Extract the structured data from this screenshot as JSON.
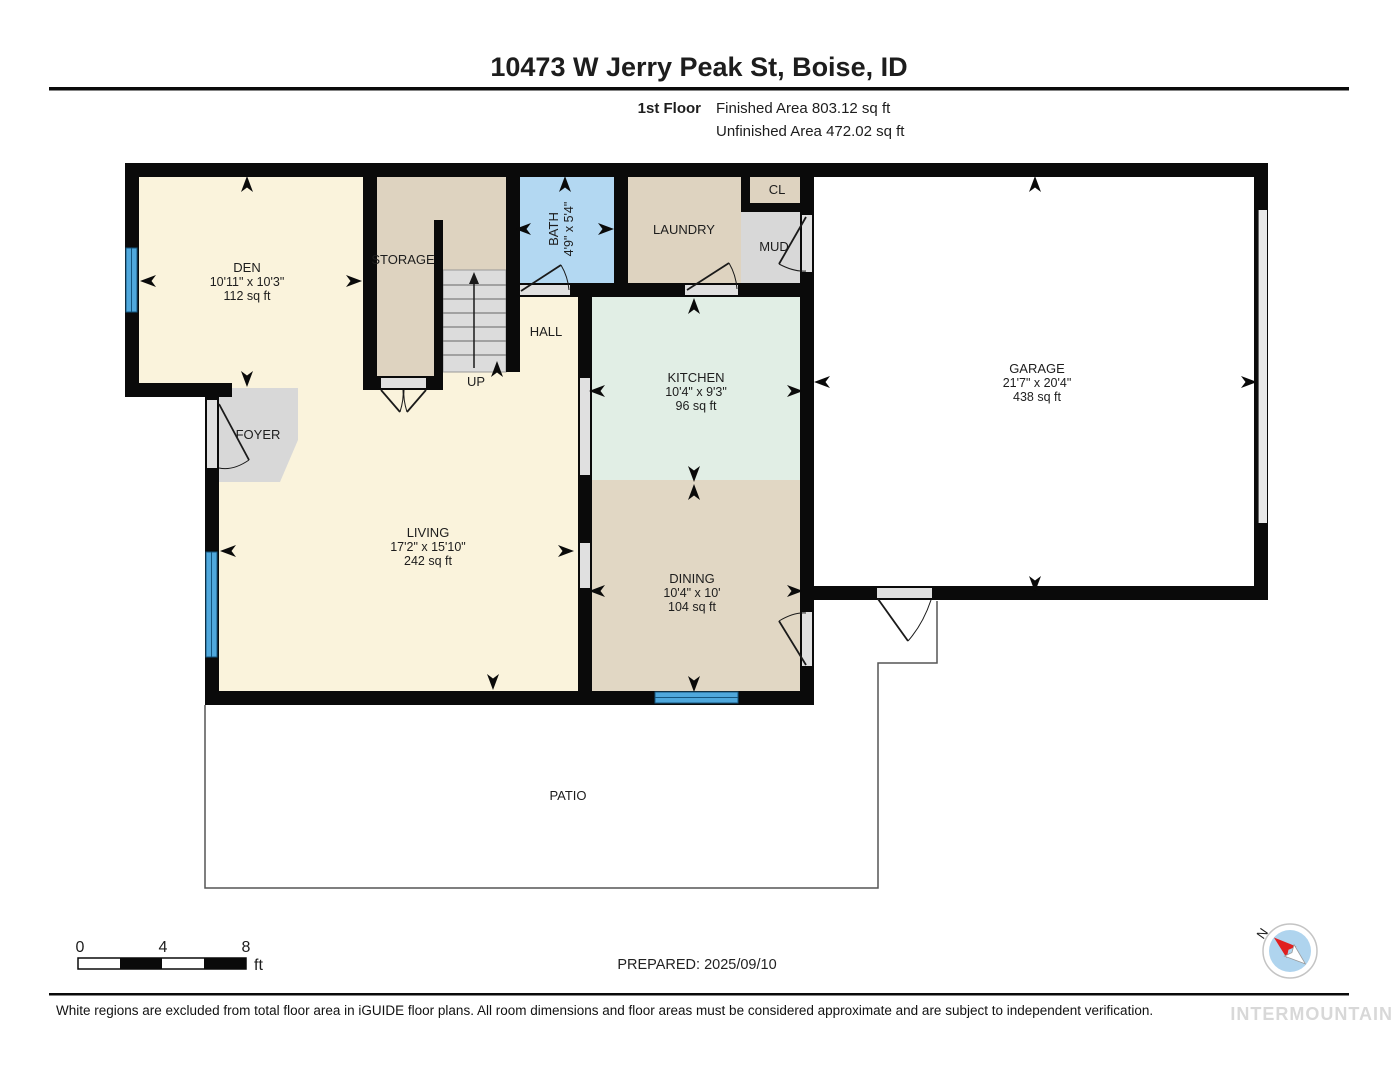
{
  "header": {
    "title": "10473 W Jerry Peak St, Boise, ID",
    "floor_label": "1st Floor",
    "finished": "Finished Area 803.12 sq ft",
    "unfinished": "Unfinished Area 472.02 sq ft"
  },
  "rooms": {
    "den": {
      "name": "DEN",
      "dims": "10'11\" x 10'3\"",
      "area": "112 sq ft"
    },
    "storage": {
      "name": "STORAGE"
    },
    "bath": {
      "name": "BATH",
      "dims": "4'9\" x 5'4\""
    },
    "laundry": {
      "name": "LAUNDRY"
    },
    "closet": {
      "name": "CL"
    },
    "mud": {
      "name": "MUD"
    },
    "hall": {
      "name": "HALL"
    },
    "up": {
      "name": "UP"
    },
    "foyer": {
      "name": "FOYER"
    },
    "kitchen": {
      "name": "KITCHEN",
      "dims": "10'4\" x 9'3\"",
      "area": "96 sq ft"
    },
    "garage": {
      "name": "GARAGE",
      "dims": "21'7\" x 20'4\"",
      "area": "438 sq ft"
    },
    "living": {
      "name": "LIVING",
      "dims": "17'2\" x 15'10\"",
      "area": "242 sq ft"
    },
    "dining": {
      "name": "DINING",
      "dims": "10'4\" x 10'",
      "area": "104 sq ft"
    },
    "patio": {
      "name": "PATIO"
    }
  },
  "footer": {
    "scale": {
      "zero": "0",
      "four": "4",
      "eight": "8",
      "unit": "ft"
    },
    "prepared": "PREPARED: 2025/09/10",
    "compass_north": "N",
    "disclaimer": "White regions are excluded from total floor area in iGUIDE floor plans. All room dimensions and floor areas must be considered approximate and are subject to independent verification.",
    "watermark": "INTERMOUNTAIN"
  },
  "colors": {
    "wall": "#0a0a0a",
    "cream_room": "#faf3dc",
    "tan_room": "#ded3c0",
    "dining_room": "#e1d7c4",
    "kitchen_room": "#e1eee5",
    "bath_room": "#b3d8f2",
    "gray_room": "#d8d8d8",
    "stairs": "#dcdcdc",
    "window_blue": "#4fa8dc",
    "opening_gray": "#e0e0e0",
    "compass_blue": "#afd4ee",
    "compass_red": "#e02020",
    "watermark_gray": "#d8d8d8"
  }
}
